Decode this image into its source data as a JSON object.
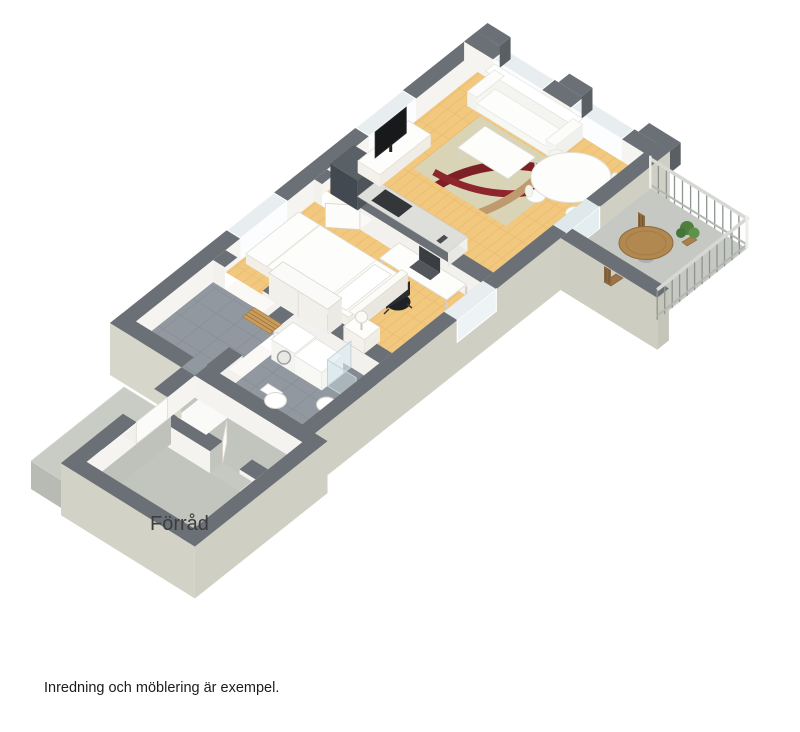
{
  "floorplan": {
    "type": "3d-isometric-floorplan",
    "storage_label": "Förråd",
    "caption": "Inredning och möblering är exempel.",
    "entrance_arrow": "black-arrow-pointing-northeast",
    "colors": {
      "background": "#ffffff",
      "wall_top": "#6a7076",
      "wall_inner_face": "#f6f4f0",
      "exterior_side": "#cfcfc3",
      "wood_floor": "#f2c87f",
      "tile_floor": "#9298a0",
      "balcony_floor": "#c6c8c4",
      "storage_floor": "#c2c4be",
      "rug": "#d9d4b6",
      "rug_accent_red": "#7c2026",
      "rug_accent_tan": "#bf9a6e",
      "window_glass": "#e8eef0",
      "balcony_wood": "#b28851"
    }
  }
}
